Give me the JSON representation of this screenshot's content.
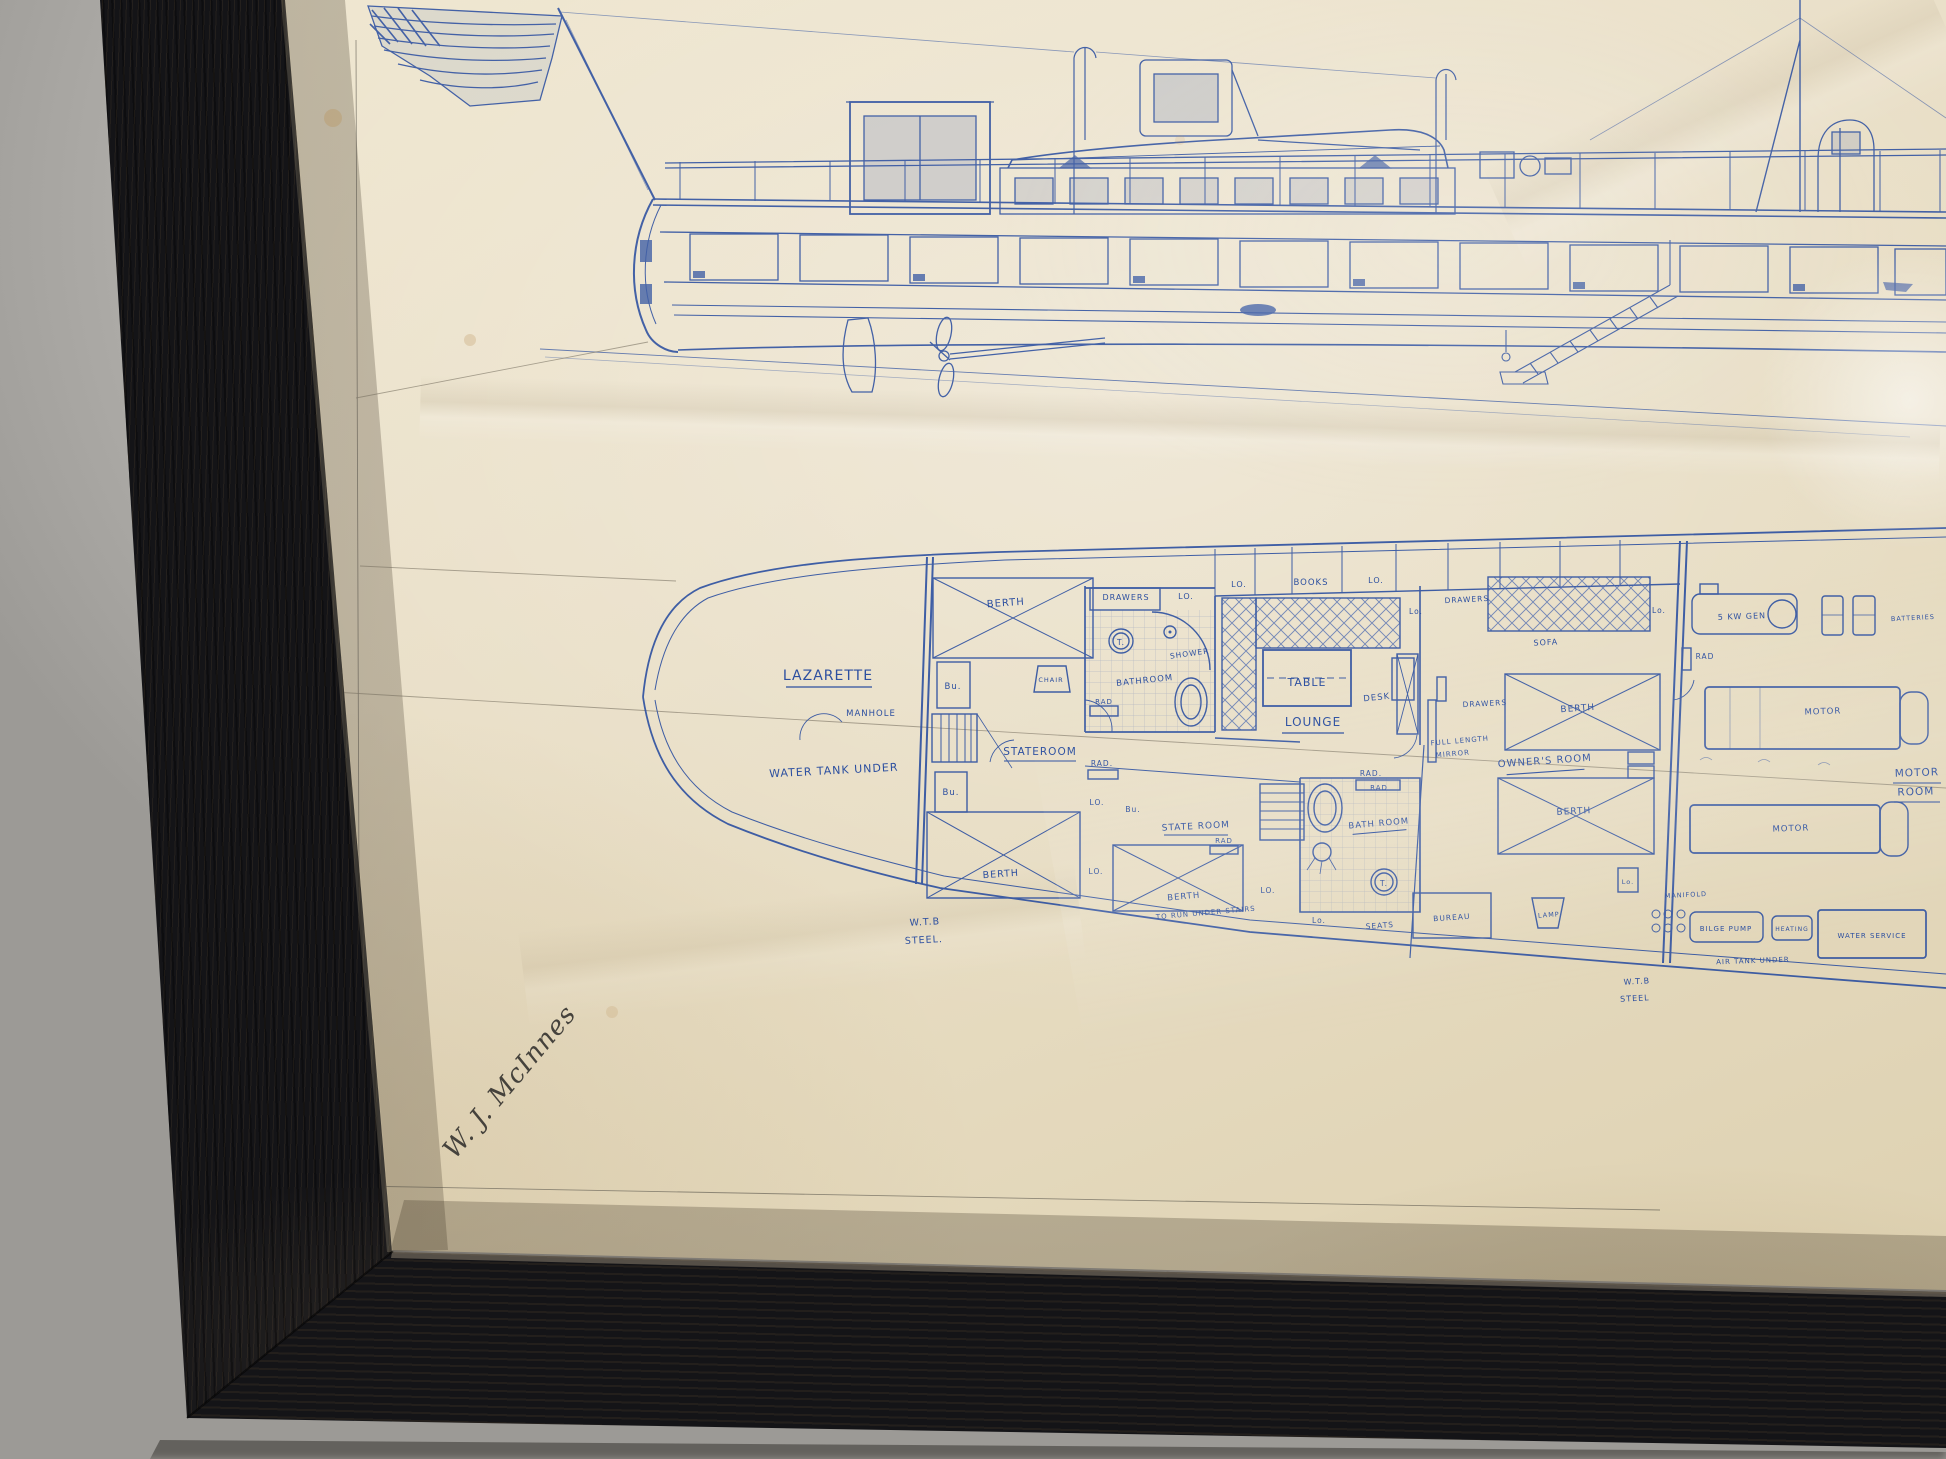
{
  "scene": {
    "ink_color": "#2c4fa0",
    "paper_color": "#eae0c9",
    "frame_color": "#141417",
    "wall_color": "#c6c4c0"
  },
  "labels": {
    "lazarette": "LAZARETTE",
    "manhole": "MANHOLE",
    "water_tank_under": "WATER TANK UNDER",
    "berth": "BERTH",
    "to_run": "TO RUN UNDER STAIRS",
    "bu": "Bu.",
    "chair": "CHAIR",
    "stateroom": "STATEROOM",
    "state_room": "STATE ROOM",
    "drawers": "DRAWERS",
    "lo": "LO.",
    "lo2": "Lo.",
    "books": "BOOKS",
    "toilet": "T.",
    "shower": "SHOWER",
    "bathroom": "BATHROOM",
    "bath_room": "BATH ROOM",
    "rad": "RAD",
    "rad_dot": "RAD.",
    "table": "TABLE",
    "lounge": "LOUNGE",
    "desk": "DESK",
    "full_length": "FULL LENGTH",
    "mirror": "MIRROR",
    "owners_room": "OWNER'S ROOM",
    "sofa": "SOFA",
    "seats": "SEATS",
    "bureau": "BUREAU",
    "lamp": "LAMP",
    "wtb": "W.T.B",
    "steel_dot": "STEEL.",
    "steel": "STEEL",
    "gen": "5 KW GEN",
    "batteries": "BATTERIES",
    "motor": "MOTOR",
    "room": "ROOM",
    "manifold": "MANIFOLD",
    "bilge_pump": "BILGE PUMP",
    "heating": "HEATING",
    "water_service": "WATER SERVICE",
    "air_tank_under": "AIR TANK UNDER"
  },
  "signature": "W. J. McInnes"
}
